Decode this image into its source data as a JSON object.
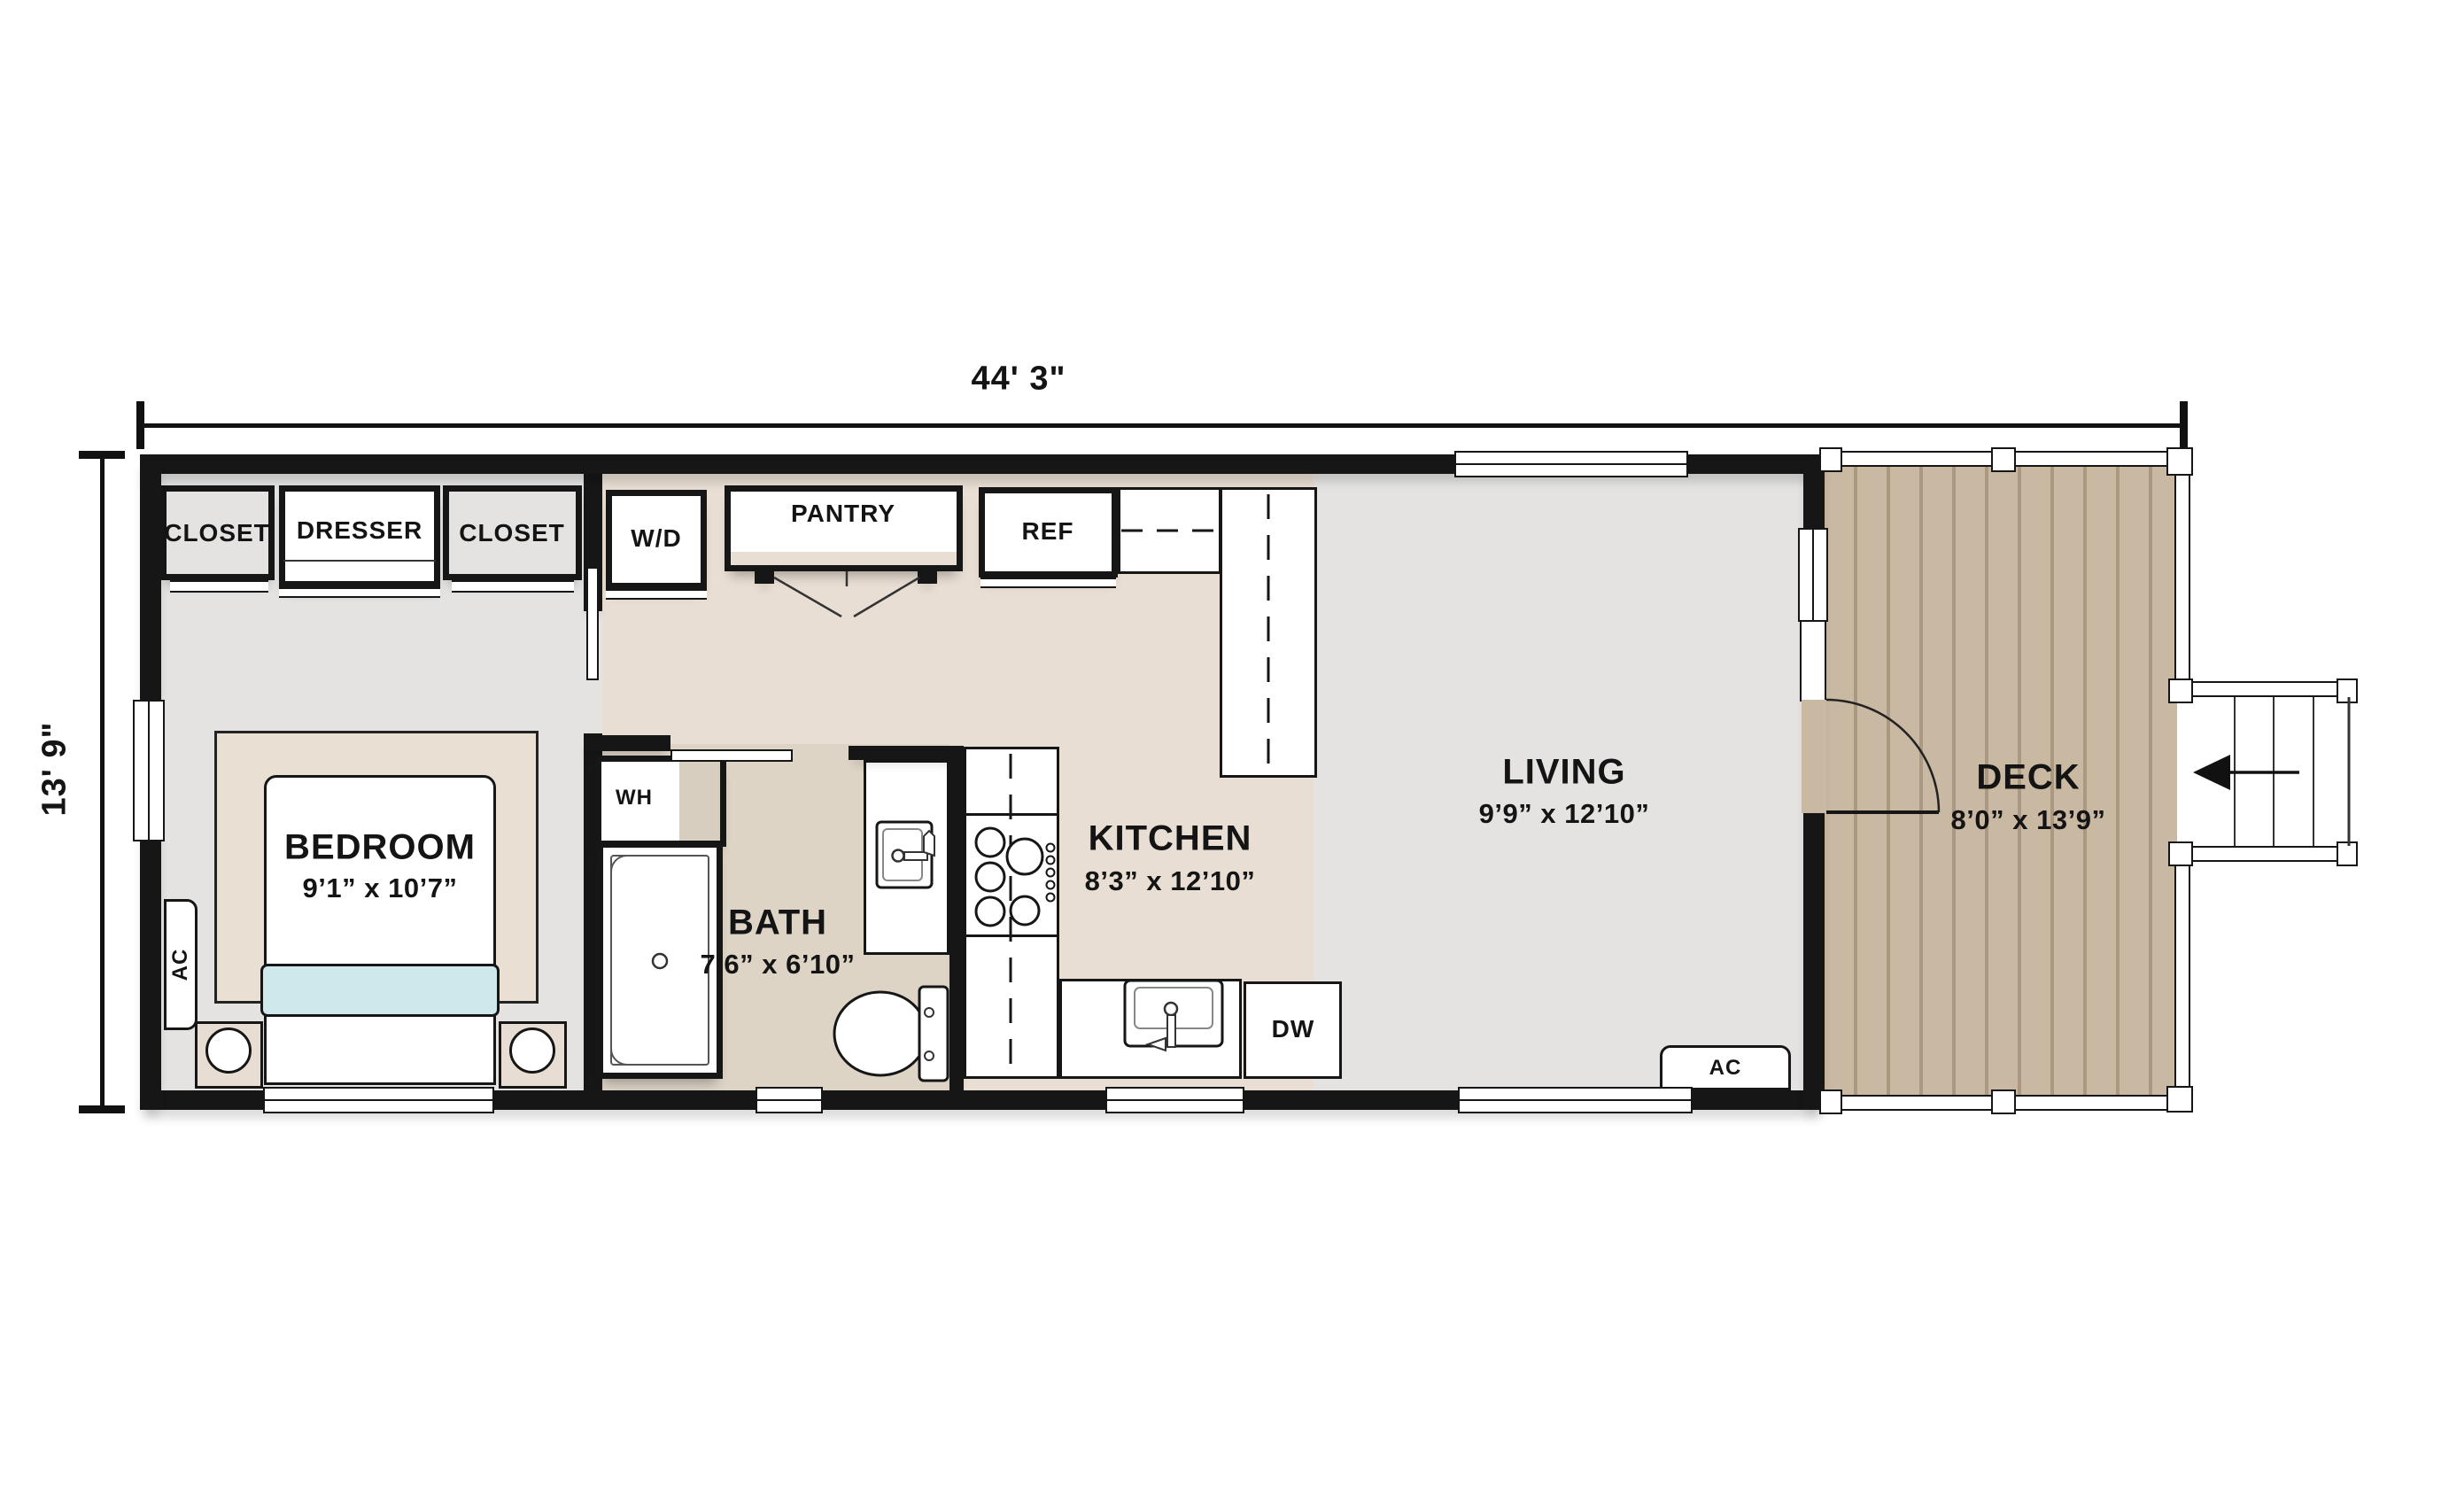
{
  "dimensions": {
    "width_label": "44' 3\"",
    "height_label": "13' 9\""
  },
  "rooms": {
    "bedroom": {
      "name": "BEDROOM",
      "size": "9’1” x 10’7”"
    },
    "bath": {
      "name": "BATH",
      "size": "7’6” x 6’10”"
    },
    "kitchen": {
      "name": "KITCHEN",
      "size": "8’3” x 12’10”"
    },
    "living": {
      "name": "LIVING",
      "size": "9’9” x 12’10”"
    },
    "deck": {
      "name": "DECK",
      "size": "8’0” x 13’9”"
    }
  },
  "labels": {
    "closet_left": "CLOSET",
    "dresser": "DRESSER",
    "closet_right": "CLOSET",
    "washer_dryer": "W/D",
    "pantry": "PANTRY",
    "refrigerator": "REF",
    "water_heater": "WH",
    "dishwasher": "DW",
    "ac_bedroom": "AC",
    "ac_living": "AC"
  },
  "colors": {
    "wall": "#161616",
    "floor-gray": "#e4e3e2",
    "floor-beige": "#e8ded3",
    "floor-bath": "#ddd4c6",
    "rug": "#eadfd3",
    "deck": "#c9b8a2",
    "blanket": "#cfe8ec",
    "wh-floor": "#d8cec0"
  }
}
